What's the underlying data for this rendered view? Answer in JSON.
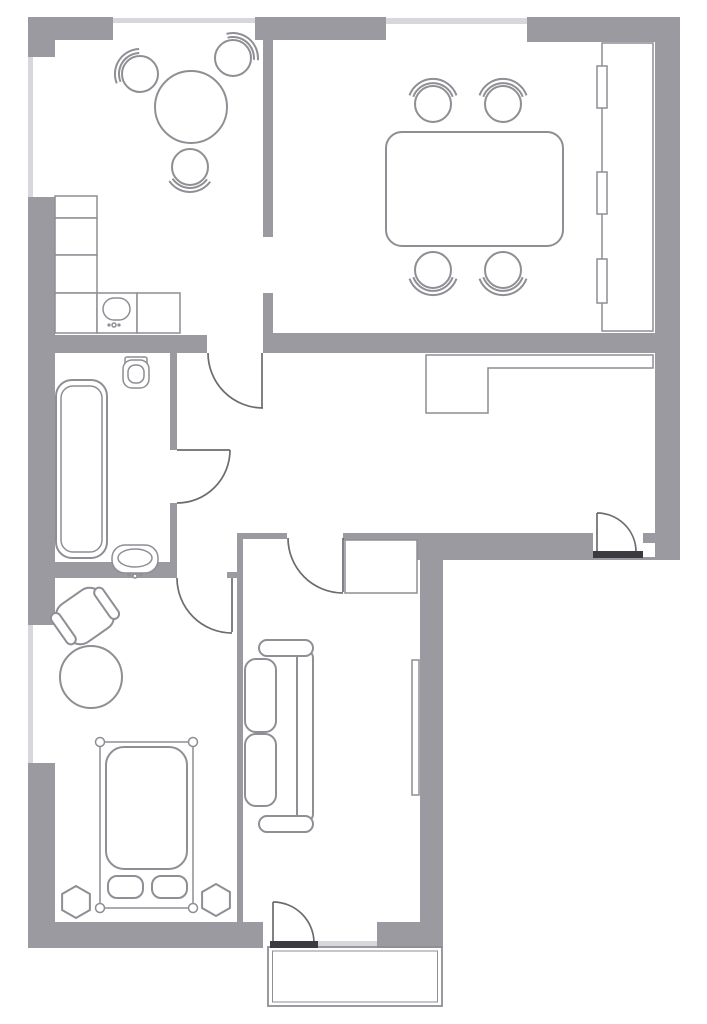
{
  "meta": {
    "kind": "apartment-floor-plan",
    "text_labels": []
  },
  "palette": {
    "surface": "#ffffff",
    "wall": "#9a9aa0",
    "window": "#d8d8dc",
    "line": "#8e8e94",
    "door": "#6b6b71",
    "threshold": "#3a3a40"
  },
  "rooms": [
    {
      "name": "kitchen",
      "furniture": [
        "round-table",
        "chair",
        "chair",
        "chair",
        "l-shaped-counter",
        "kitchen-sink"
      ]
    },
    {
      "name": "dining-room",
      "furniture": [
        "rectangular-table",
        "chair",
        "chair",
        "chair",
        "chair",
        "built-in-unit-3-sections"
      ]
    },
    {
      "name": "bathroom",
      "furniture": [
        "bathtub",
        "toilet",
        "washbasin"
      ]
    },
    {
      "name": "hallway",
      "furniture": [
        "built-in-closet"
      ]
    },
    {
      "name": "bedroom",
      "furniture": [
        "double-bed",
        "pillow",
        "pillow",
        "hexagon-bedside-table",
        "hexagon-bedside-table",
        "armchair",
        "round-side-table"
      ]
    },
    {
      "name": "living-room",
      "furniture": [
        "sofa",
        "wardrobe",
        "tv-panel"
      ]
    },
    {
      "name": "balcony",
      "furniture": []
    }
  ],
  "openings": {
    "interior_doors": 4,
    "entrance_door": 1,
    "balcony_door": 1,
    "windows": 5,
    "thresholds": 2
  }
}
